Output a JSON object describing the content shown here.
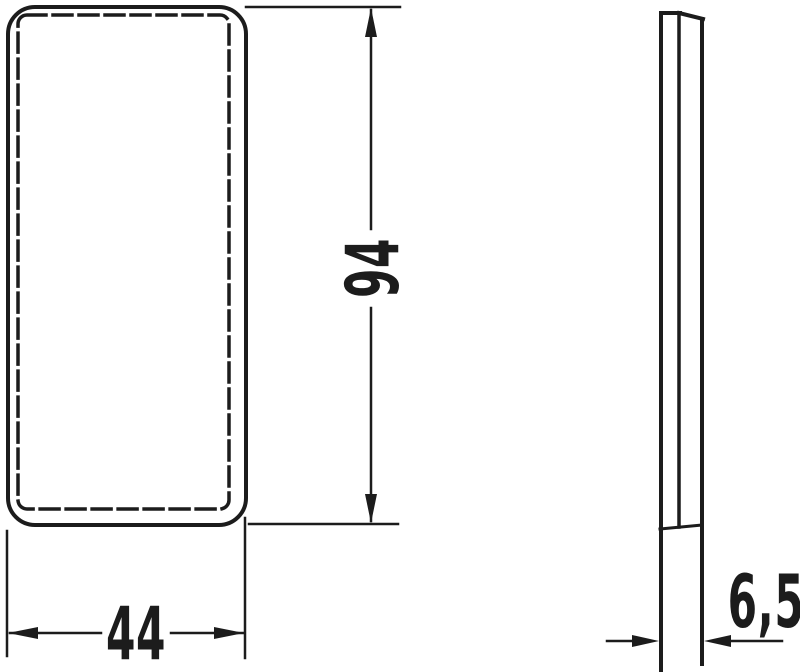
{
  "colors": {
    "background": "#ffffff",
    "ink": "#1c1c1c"
  },
  "drawing": {
    "type": "technical-dimension-drawing",
    "dimensions": {
      "width": "44",
      "height": "94",
      "thickness": "6,5"
    }
  }
}
